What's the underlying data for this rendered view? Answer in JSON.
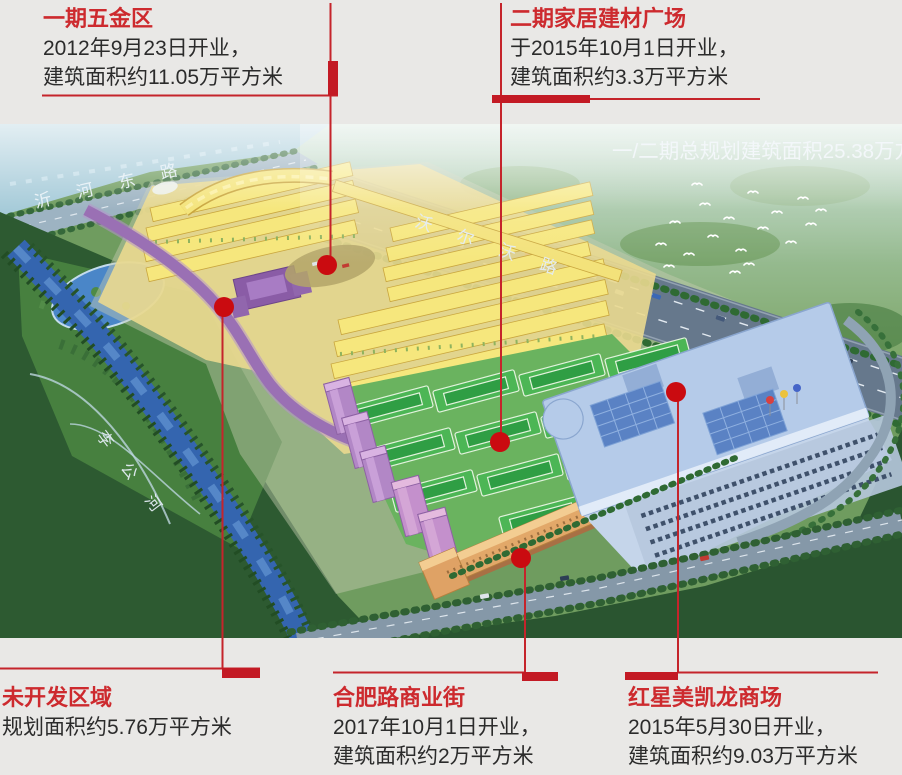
{
  "canvas": {
    "width": 902,
    "height": 775,
    "background": "#e9e8e6"
  },
  "palette": {
    "title_red": "#cd2a2e",
    "leader_line_red": "#c5242b",
    "marker_dot_red": "#ca0b10",
    "body_text": "#2b2b2b"
  },
  "callouts": [
    {
      "id": "phase1",
      "title": "一期五金区",
      "lines": [
        "2012年9月23日开业，",
        "建筑面积约11.05万平方米"
      ]
    },
    {
      "id": "phase2",
      "title": "二期家居建材广场",
      "lines": [
        "于2015年10月1日开业，",
        "建筑面积约3.3万平方米"
      ]
    },
    {
      "id": "undeveloped",
      "title": "未开发区域",
      "lines": [
        "规划面积约5.76万平方米"
      ]
    },
    {
      "id": "hefei-road",
      "title": "合肥路商业街",
      "lines": [
        "2017年10月1日开业，",
        "建筑面积约2万平方米"
      ]
    },
    {
      "id": "redstar",
      "title": "红星美凯龙商场",
      "lines": [
        "2015年5月30日开业，",
        "建筑面积约9.03万平方米"
      ]
    }
  ],
  "map": {
    "overlay_note": "一/二期总规划建筑面积25.38万方",
    "labels": {
      "yihe_east_road": "沂河东路",
      "volvo_road": "沃尔沃路",
      "ligong_river": "李公河"
    }
  }
}
